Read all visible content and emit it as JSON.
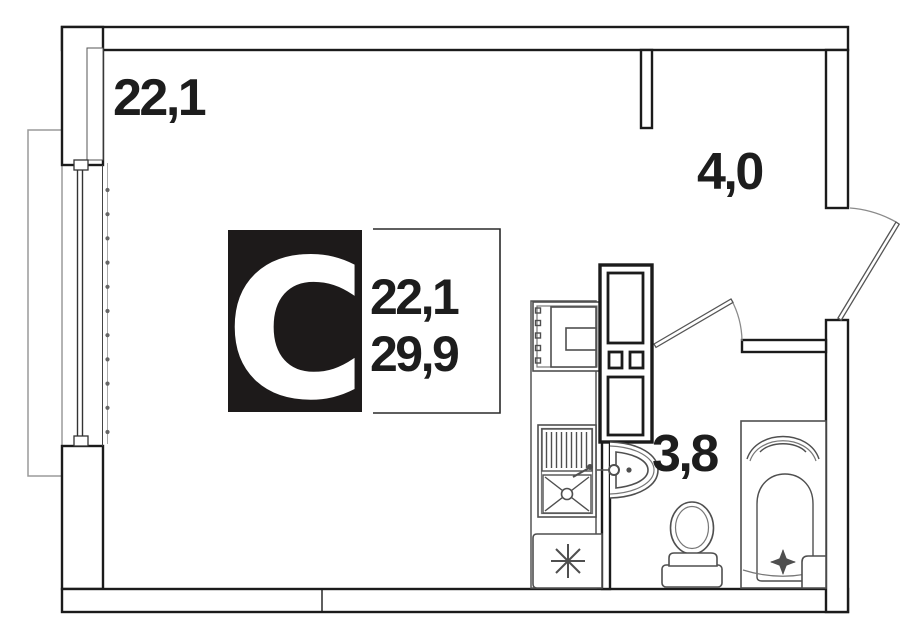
{
  "plan": {
    "type_label": "С",
    "info_box": {
      "living_area": "22,1",
      "total_area": "29,9"
    },
    "rooms": [
      {
        "id": "living-room",
        "area_label": "22,1"
      },
      {
        "id": "hallway",
        "area_label": "4,0"
      },
      {
        "id": "bathroom",
        "area_label": "3,8"
      }
    ],
    "fixtures": [
      "balcony",
      "window",
      "entrance-door",
      "bathroom-door",
      "wardrobe",
      "stove",
      "kitchen-sink",
      "refrigerator",
      "wash-basin",
      "toilet",
      "bathtub"
    ],
    "colors": {
      "wall": "#1b1b1b",
      "fixture": "#4f4f4f",
      "door": "#8a8a8a",
      "balcony": "#9a9a9a",
      "text": "#1d1d1d",
      "label_box_background": "#1d1a1a",
      "label_letter": "#ffffff",
      "background": "#ffffff"
    }
  }
}
